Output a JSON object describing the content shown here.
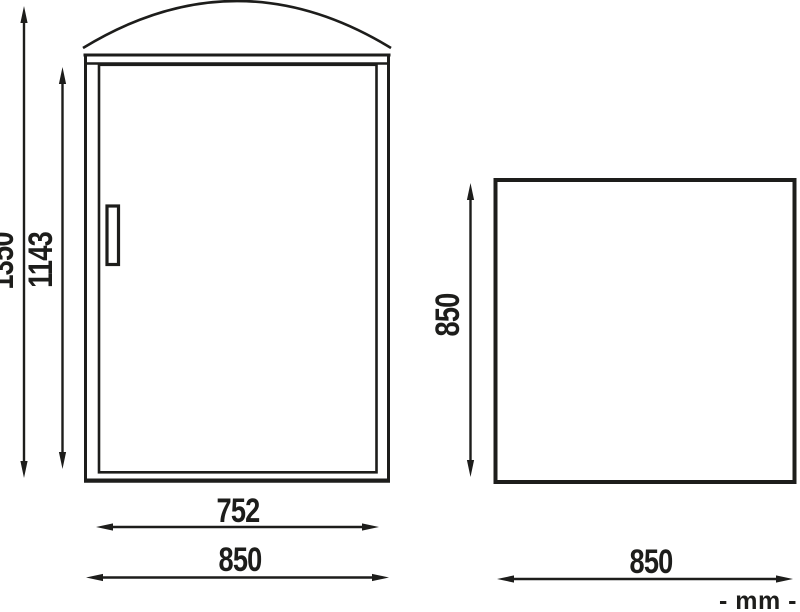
{
  "colors": {
    "line": "#1d1d1b",
    "background": "#ffffff"
  },
  "front_view": {
    "overall_height": "1350",
    "door_height": "1143",
    "door_width": "752",
    "overall_width": "850"
  },
  "side_view": {
    "side_height": "850",
    "side_width": "850"
  },
  "units_label": "- mm -"
}
